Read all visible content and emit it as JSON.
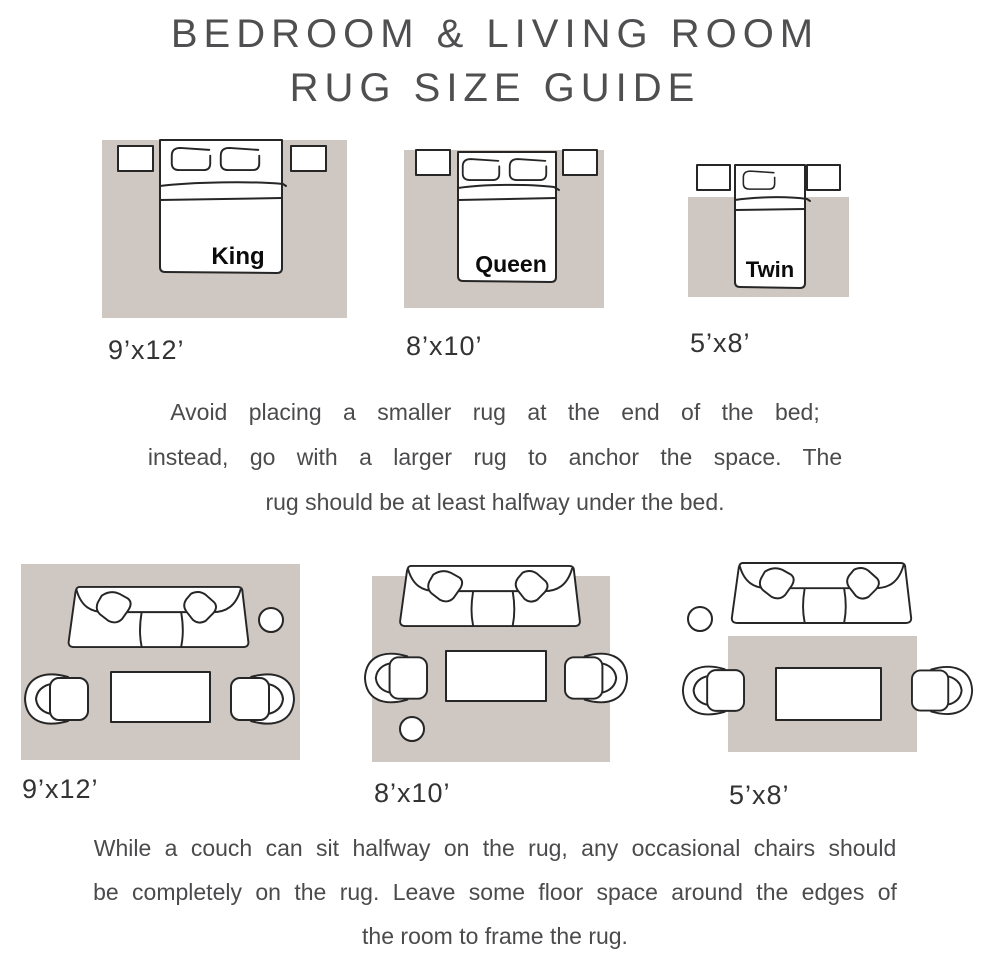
{
  "title": {
    "line1": "BEDROOM & LIVING ROOM",
    "line2": "RUG SIZE GUIDE"
  },
  "bedroom": {
    "diagrams": [
      {
        "bed_label": "King",
        "rug_size": "9’x12’"
      },
      {
        "bed_label": "Queen",
        "rug_size": "8’x10’"
      },
      {
        "bed_label": "Twin",
        "rug_size": "5’x8’"
      }
    ],
    "tip_lines": [
      "Avoid placing a smaller rug at the end of the bed;",
      "instead, go with a larger rug to anchor the space. The",
      "rug should be at least halfway under the bed."
    ]
  },
  "living_room": {
    "diagrams": [
      {
        "rug_size": "9’x12’"
      },
      {
        "rug_size": "8’x10’"
      },
      {
        "rug_size": "5’x8’"
      }
    ],
    "tip_lines": [
      "While a couch can sit halfway on the rug, any occasional chairs should",
      "be completely on the rug. Leave some floor space around the edges of",
      "the room to frame the rug."
    ]
  },
  "colors": {
    "rug": "#cfc7c2",
    "furniture_outline": "#262626",
    "furniture_fill": "#ffffff",
    "title_text": "#4f4f51",
    "body_text": "#4b4b4d",
    "label_text": "#333333",
    "bed_label_text": "#0b0b0b"
  }
}
